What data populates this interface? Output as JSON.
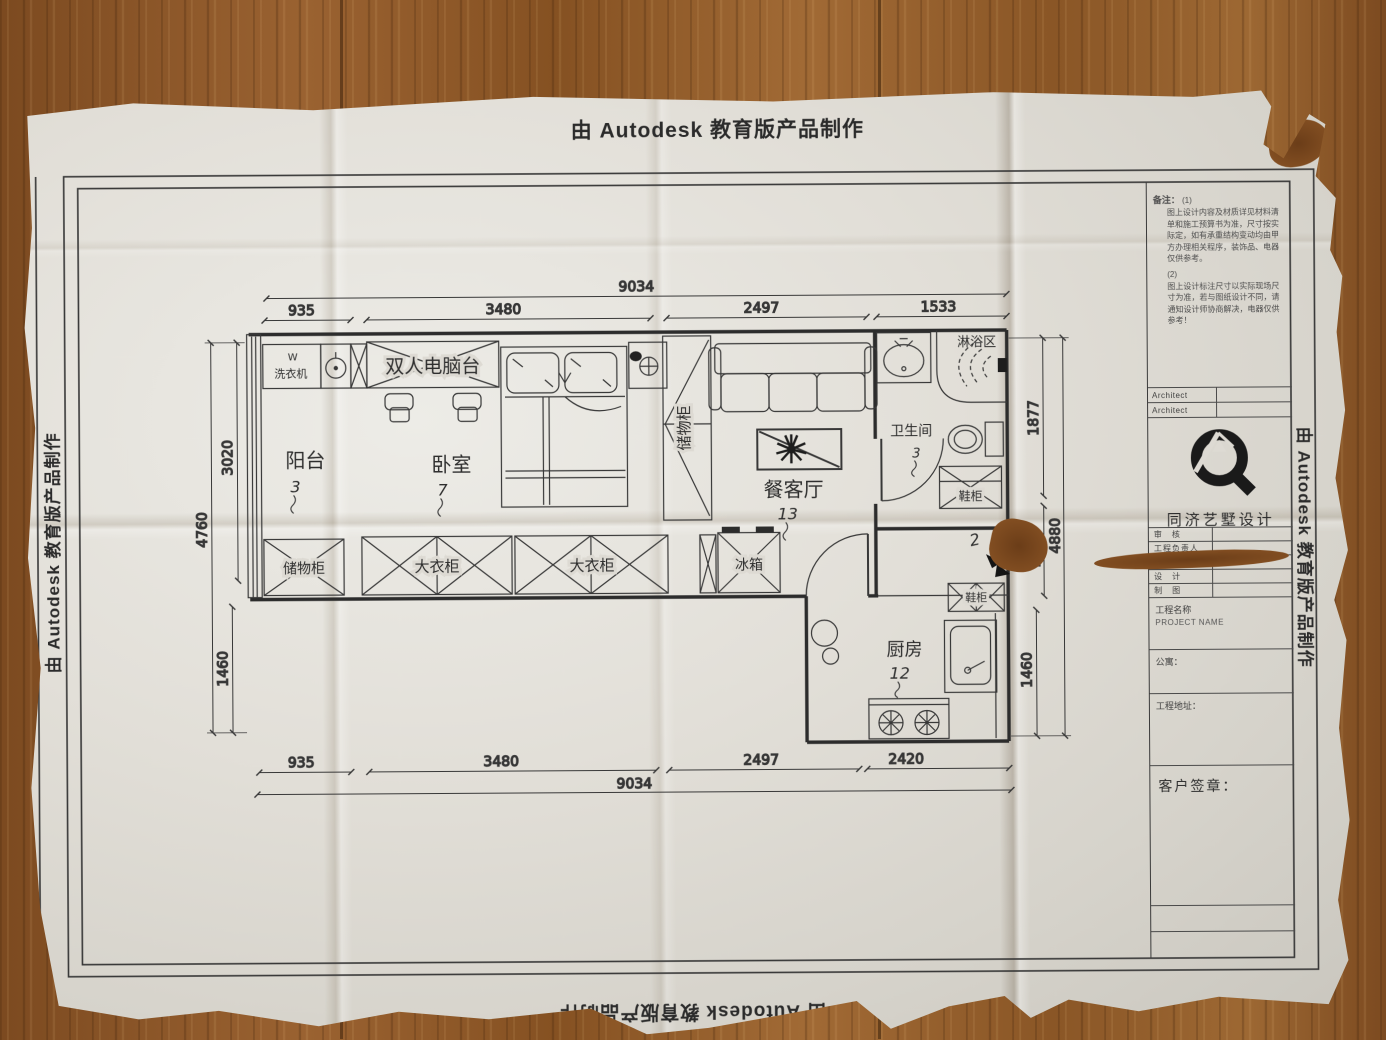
{
  "stamps": {
    "top": "由 Autodesk 教育版产品制作",
    "bottom": "由 Autodesk 教育版产品制作",
    "left": "由 Autodesk 教育版产品制作",
    "right": "由 Autodesk 教育版产品制作"
  },
  "floor_plan": {
    "rooms": {
      "balcony": {
        "name": "阳台",
        "num": "3"
      },
      "bedroom": {
        "name": "卧室",
        "num": "7"
      },
      "living": {
        "name": "餐客厅",
        "num": "13"
      },
      "bath": {
        "name": "卫生间",
        "num": "3"
      },
      "shower": {
        "name": "淋浴区"
      },
      "kitchen": {
        "name": "厨房",
        "num": "12"
      },
      "entry_num": "2"
    },
    "furniture": {
      "washer_w": "W",
      "washer": "洗衣机",
      "desk": "双人电脑台",
      "closet_col": "储物柜",
      "storage": "储物柜",
      "wardrobe1": "大衣柜",
      "wardrobe2": "大衣柜",
      "fridge": "冰箱",
      "shoe_bath": "鞋柜",
      "shoe_hall": "鞋柜"
    },
    "dims": {
      "top_overall": "9034",
      "top_seg1": "935",
      "top_seg2": "3480",
      "top_seg3": "2497",
      "top_seg4": "1533",
      "bottom_seg1": "935",
      "bottom_seg2": "3480",
      "bottom_seg3": "2497",
      "bottom_seg4": "2420",
      "bottom_overall": "9034",
      "left_outer": "4760",
      "left_seg1": "3020",
      "left_seg2": "1460",
      "right_seg1": "1877",
      "right_seg2": "1093",
      "right_seg3": "1460",
      "right_overall": "4880"
    }
  },
  "titleblock": {
    "notes_label": "备注：",
    "note1_no": "(1)",
    "note1": "图上设计内容及材质详见材料清单和施工预算书为准，尺寸按实际定，如有承重结构变动均由甲方办理相关程序，装饰品、电器仅供参考。",
    "note2_no": "(2)",
    "note2": "图上设计标注尺寸以实际现场尺寸为准，若与图纸设计不同，请通知设计师协商解决，电器仅供参考！",
    "architect1": "Architect",
    "architect2": "Architect",
    "company": "同济艺墅设计",
    "row1": "审　核",
    "row2": "工程负责人",
    "row3": "校　对",
    "row4": "设　计",
    "row5": "制　图",
    "project_label": "工程名称",
    "project_en": "PROJECT NAME",
    "apartment": "公寓：",
    "address": "工程地址：",
    "signature": "客户签章："
  }
}
